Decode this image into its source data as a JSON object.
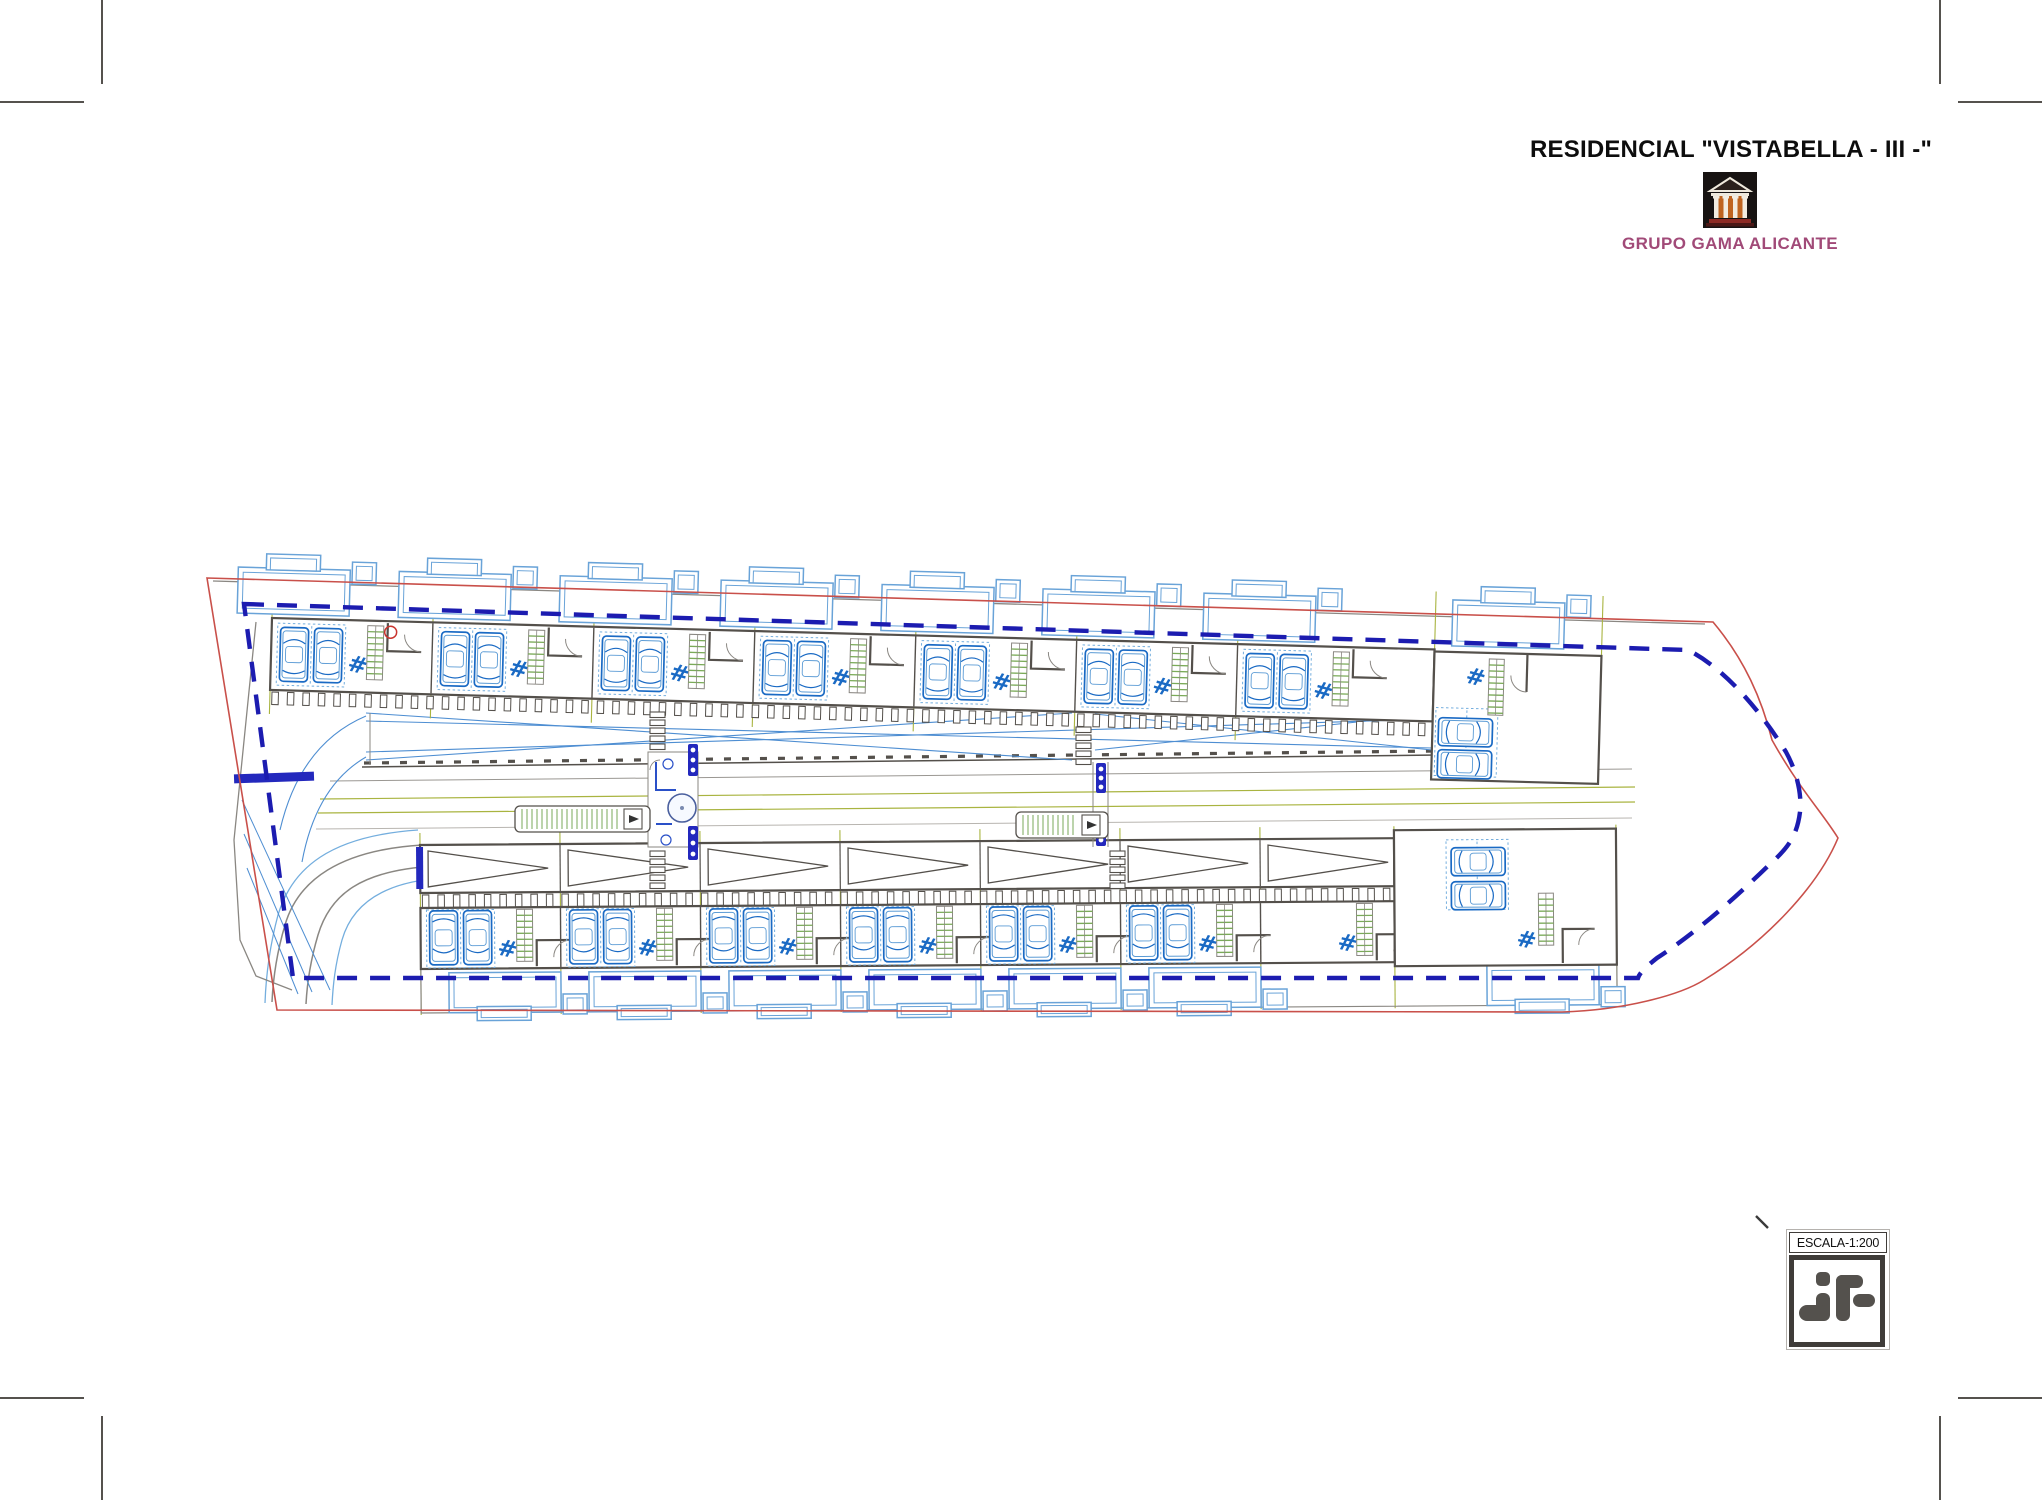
{
  "sheet": {
    "width": 2042,
    "height": 1500
  },
  "header": {
    "title": "RESIDENCIAL \"VISTABELLA - III -\"",
    "company": "GRUPO GAMA ALICANTE"
  },
  "logo": {
    "name": "grupo-gama-temple-logo",
    "bg": "#171312",
    "column_color": "#f2ece0",
    "glow_color": "#bf6420",
    "base_color": "#8c2a24",
    "base2_color": "#4a1715"
  },
  "scale_box": {
    "label": "ESCALA-1:200",
    "logo_name": "jf-architect-logo",
    "logo_color": "#54514d"
  },
  "plan": {
    "gate_symbol": "#",
    "colors": {
      "wall": "#54504b",
      "thin": "#8a8782",
      "red": "#c9504a",
      "dash": "#1c1cb0",
      "car": "#1a6ac4",
      "car_light": "#5b9bd5",
      "pad": "#74aede",
      "stair": "#7aaa58",
      "olive": "#a9b440",
      "terrace": "#69a3d8",
      "diag": "#4e8ed2",
      "navy": "#2328bd"
    },
    "red_path": "M207,578 L1713,622 C1745,660 1762,700 1772,740 C1800,790 1822,812 1838,838 C1818,886 1766,942 1704,980 C1680,995 1625,1010 1562,1012 L277,1010 Z",
    "blue_path": "M244,604 L1688,650 C1724,668 1760,710 1786,752 C1797,772 1802,795 1800,812 C1797,836 1788,848 1770,864 C1738,895 1700,930 1657,958 C1647,966 1640,972 1638,978 L293,978 Z",
    "top_row": {
      "x": 272,
      "y": 618,
      "angle": 1.55,
      "units": 7,
      "pitch": 161,
      "band_w": 1163,
      "band_h": 72,
      "lot_lines": [
        0,
        161,
        322,
        483,
        644,
        805,
        966,
        1163,
        1330
      ],
      "terraces_x": [
        -35,
        126,
        287,
        448,
        609,
        770,
        931,
        1180
      ]
    },
    "bottom_row": {
      "x": 420,
      "y": 845,
      "angle": -0.4,
      "units": 6,
      "pitch": 140,
      "band_w": 974,
      "end_w": 222,
      "lot_lines": [
        0,
        140,
        280,
        420,
        560,
        700,
        840,
        974,
        1196
      ],
      "terraces_x": [
        28,
        168,
        308,
        448,
        588,
        728,
        1066
      ]
    }
  }
}
